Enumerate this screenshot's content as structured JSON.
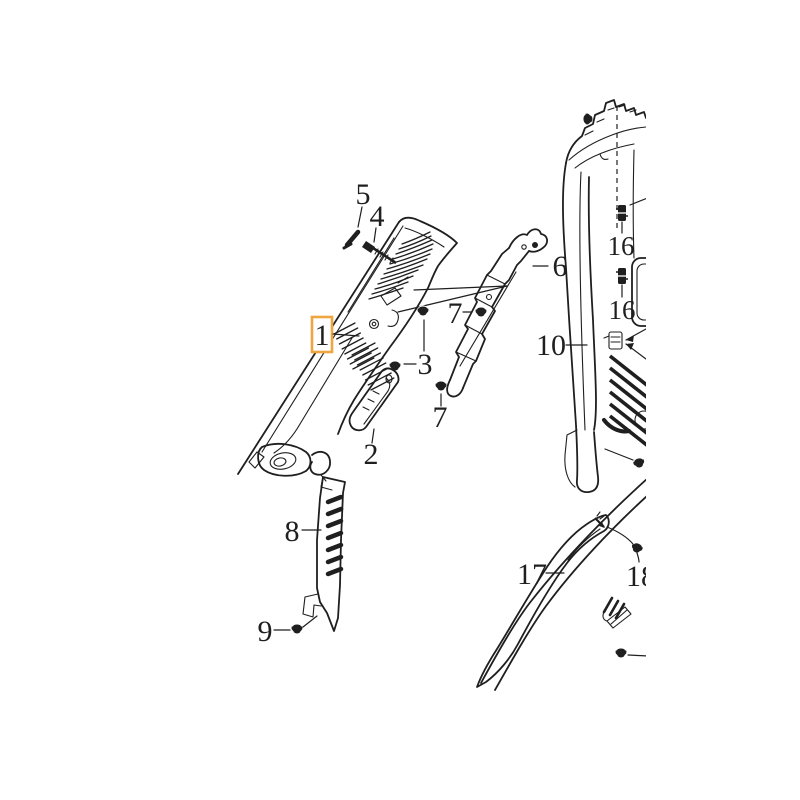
{
  "diagram": {
    "type": "exploded-parts-diagram",
    "description": "Vehicle interior pillar trim panels exploded view with numbered callouts",
    "colors": {
      "bg": "#ffffff",
      "line": "#1f1f1f",
      "highlight": "#F0A640",
      "text": "#1f1f1f"
    },
    "selected_callout": "1",
    "callouts": [
      {
        "label": "1",
        "selected": true
      },
      {
        "label": "2"
      },
      {
        "label": "3"
      },
      {
        "label": "4"
      },
      {
        "label": "5"
      },
      {
        "label": "6"
      },
      {
        "label": "7"
      },
      {
        "label": "7"
      },
      {
        "label": "8"
      },
      {
        "label": "9"
      },
      {
        "label": "10"
      },
      {
        "label": "16"
      },
      {
        "label": "16"
      },
      {
        "label": "17"
      },
      {
        "label": "18"
      }
    ]
  }
}
